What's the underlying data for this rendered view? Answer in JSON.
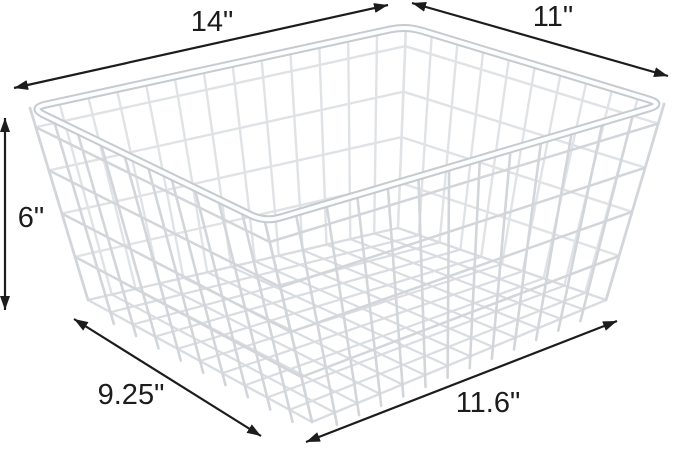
{
  "scene": {
    "kind": "product-dimension-diagram",
    "subject": "wire storage basket",
    "background_color": "#ffffff"
  },
  "annotations": {
    "color": "#1c1c1c",
    "items": [
      {
        "id": "top-width",
        "label": "14\"",
        "edge": "top rim long side"
      },
      {
        "id": "top-depth",
        "label": "11\"",
        "edge": "top rim short side"
      },
      {
        "id": "height",
        "label": "6\"",
        "edge": "basket height"
      },
      {
        "id": "bottom-depth",
        "label": "9.25\"",
        "edge": "bottom short side"
      },
      {
        "id": "bottom-width",
        "label": "11.6\"",
        "edge": "bottom long side"
      }
    ]
  },
  "basket": {
    "colors": {
      "back": "#e0e3e6",
      "bottom": "#d9dce0",
      "front": "#d2d6da",
      "rim_outline": "#c6cbd0",
      "rim_highlight": "#fcfdfd"
    },
    "grid": {
      "long_side_cells": 13,
      "short_side_cells": 10,
      "ring_levels": [
        0.1,
        0.325,
        0.55,
        0.775
      ]
    },
    "rim_corner_radius": 16
  }
}
